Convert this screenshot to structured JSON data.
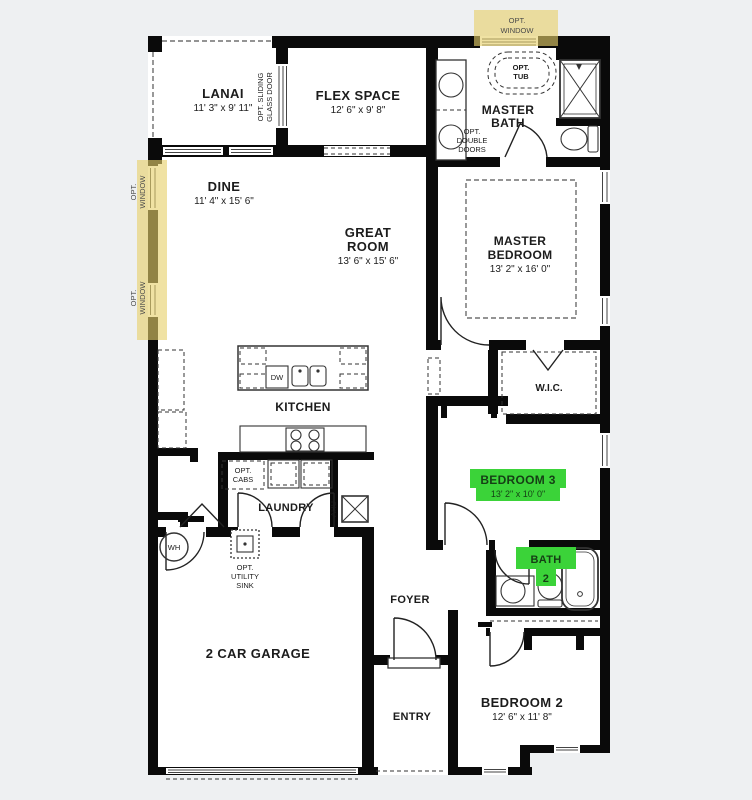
{
  "colors": {
    "background": "#eef0f2",
    "walls": "#0a0a0a",
    "floor": "#ffffff",
    "opt_window_highlight": "#e7d06a",
    "room_highlight_green": "#3bd339",
    "text": "#1c1c1c"
  },
  "rooms": {
    "lanai": {
      "name": "LANAI",
      "dims": "11' 3\" x 9' 11\""
    },
    "flex_space": {
      "name": "FLEX SPACE",
      "dims": "12' 6\" x 9' 8\""
    },
    "master_bath": {
      "line1": "MASTER",
      "line2": "BATH"
    },
    "master_bedroom": {
      "line1": "MASTER",
      "line2": "BEDROOM",
      "dims": "13' 2\" x 16' 0\""
    },
    "dine": {
      "name": "DINE",
      "dims": "11' 4\" x 15' 6\""
    },
    "great_room": {
      "line1": "GREAT",
      "line2": "ROOM",
      "dims": "13' 6\" x 15' 6\""
    },
    "wic": {
      "name": "W.I.C."
    },
    "kitchen": {
      "name": "KITCHEN"
    },
    "laundry": {
      "name": "LAUNDRY"
    },
    "bedroom_3": {
      "name": "BEDROOM 3",
      "dims": "13' 2\" x 10' 0\""
    },
    "bath_2": {
      "line1": "BATH",
      "line2": "2"
    },
    "foyer": {
      "name": "FOYER"
    },
    "entry": {
      "name": "ENTRY"
    },
    "bedroom_2": {
      "name": "BEDROOM 2",
      "dims": "12' 6\" x 11' 8\""
    },
    "garage": {
      "name": "2 CAR GARAGE"
    }
  },
  "annotations": {
    "opt_window": {
      "line1": "OPT.",
      "line2": "WINDOW"
    },
    "opt_tub": {
      "line1": "OPT.",
      "line2": "TUB"
    },
    "opt_sliding_glass_door": {
      "line1": "OPT. SLIDING",
      "line2": "GLASS DOOR"
    },
    "opt_double_doors": {
      "line1": "OPT.",
      "line2": "DOUBLE",
      "line3": "DOORS"
    },
    "opt_cabs": {
      "line1": "OPT.",
      "line2": "CABS"
    },
    "opt_utility_sink": {
      "line1": "OPT.",
      "line2": "UTILITY",
      "line3": "SINK"
    },
    "dw": "DW",
    "ahu": "AHU",
    "wh": "WH"
  }
}
